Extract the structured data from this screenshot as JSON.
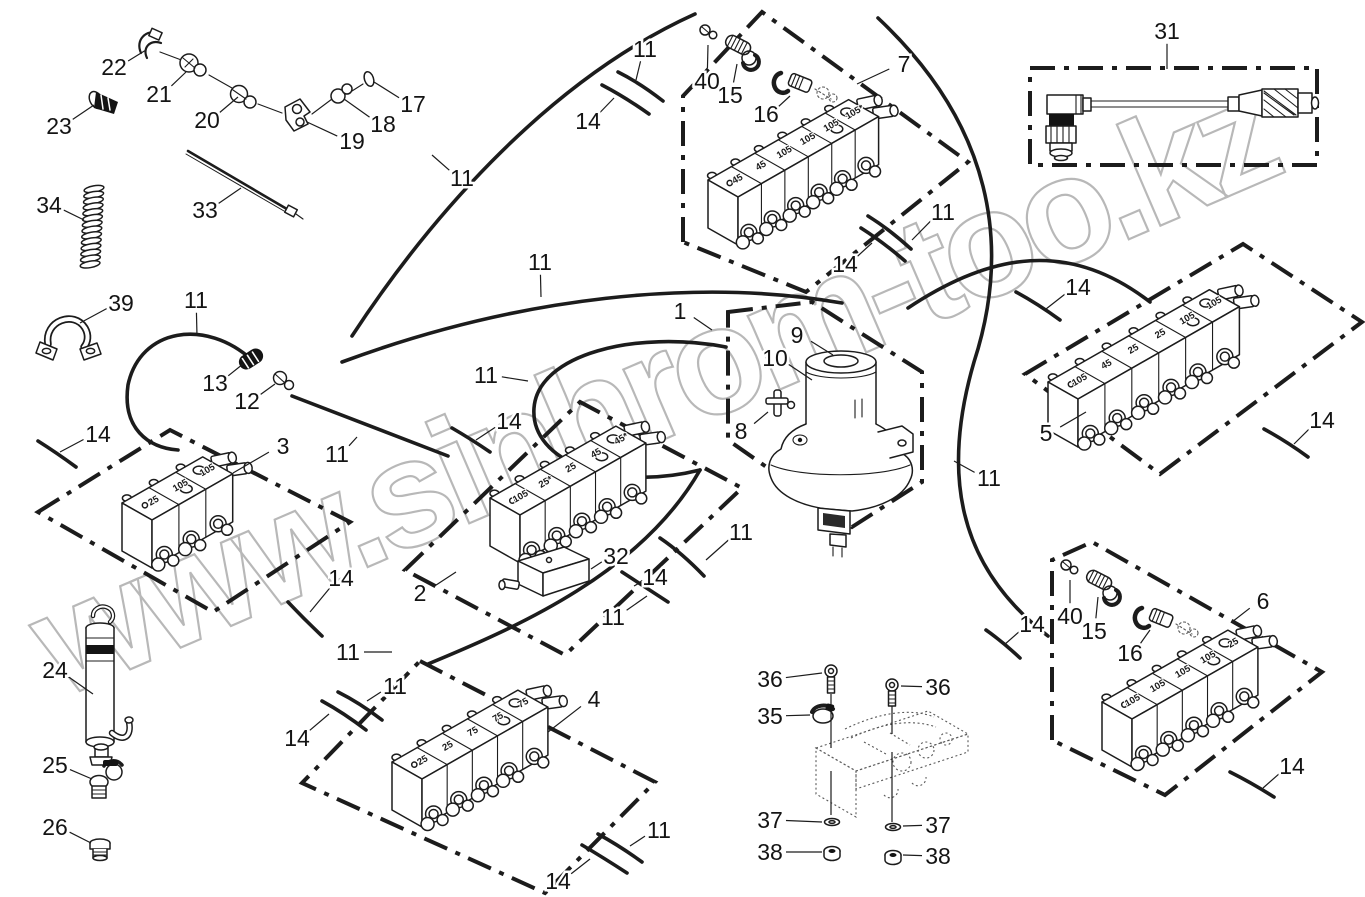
{
  "watermark": {
    "text": "www.sinhrom-too.kz",
    "color": "#acacac"
  },
  "colors": {
    "line": "#1c1c1c",
    "ghost": "#5a5a5a",
    "background": "#ffffff"
  },
  "parts_diagram": {
    "blocks": [
      {
        "ref": "7",
        "x": 708,
        "y": 180,
        "sec": 27,
        "sections": [
          "45",
          "45",
          "105",
          "105",
          "105",
          "105*"
        ]
      },
      {
        "ref": "3",
        "x": 122,
        "y": 503,
        "sec": 31,
        "sections": [
          "25",
          "105",
          "105"
        ]
      },
      {
        "ref": "2",
        "x": 490,
        "y": 498,
        "sec": 29,
        "sections": [
          "105",
          "25*",
          "25",
          "45",
          "45*"
        ]
      },
      {
        "ref": "5",
        "x": 1048,
        "y": 382,
        "sec": 31,
        "sections": [
          "105",
          "45",
          "25",
          "25",
          "105",
          "105"
        ]
      },
      {
        "ref": "4",
        "x": 392,
        "y": 762,
        "sec": 29,
        "sections": [
          "25",
          "25",
          "75",
          "75",
          "75"
        ]
      },
      {
        "ref": "6",
        "x": 1102,
        "y": 702,
        "sec": 29,
        "sections": [
          "105",
          "105",
          "105",
          "105",
          "25"
        ]
      }
    ],
    "callouts": [
      {
        "t": "22",
        "x": 114,
        "y": 67,
        "px": 146,
        "py": 50
      },
      {
        "t": "21",
        "x": 159,
        "y": 94,
        "px": 186,
        "py": 72
      },
      {
        "t": "23",
        "x": 59,
        "y": 126,
        "px": 94,
        "py": 105
      },
      {
        "t": "20",
        "x": 207,
        "y": 120,
        "px": 238,
        "py": 97
      },
      {
        "t": "19",
        "x": 352,
        "y": 141,
        "px": 307,
        "py": 122
      },
      {
        "t": "18",
        "x": 383,
        "y": 124,
        "px": 344,
        "py": 99
      },
      {
        "t": "17",
        "x": 413,
        "y": 104,
        "px": 374,
        "py": 82
      },
      {
        "t": "33",
        "x": 205,
        "y": 210,
        "px": 241,
        "py": 188
      },
      {
        "t": "34",
        "x": 49,
        "y": 205,
        "px": 84,
        "py": 220
      },
      {
        "t": "39",
        "x": 121,
        "y": 303,
        "px": 80,
        "py": 323
      },
      {
        "t": "11",
        "x": 196,
        "y": 300,
        "px": 197,
        "py": 336
      },
      {
        "t": "13",
        "x": 215,
        "y": 383,
        "px": 243,
        "py": 364
      },
      {
        "t": "12",
        "x": 247,
        "y": 401,
        "px": 275,
        "py": 384
      },
      {
        "t": "14",
        "x": 98,
        "y": 434,
        "px": 60,
        "py": 452
      },
      {
        "t": "3",
        "x": 283,
        "y": 446,
        "px": 233,
        "py": 473
      },
      {
        "t": "11",
        "x": 337,
        "y": 454,
        "px": 357,
        "py": 437
      },
      {
        "t": "14",
        "x": 341,
        "y": 578,
        "px": 310,
        "py": 612
      },
      {
        "t": "11",
        "x": 348,
        "y": 652,
        "px": 392,
        "py": 652
      },
      {
        "t": "24",
        "x": 55,
        "y": 670,
        "px": 93,
        "py": 694
      },
      {
        "t": "25",
        "x": 55,
        "y": 765,
        "px": 92,
        "py": 779
      },
      {
        "t": "26",
        "x": 55,
        "y": 827,
        "px": 91,
        "py": 843
      },
      {
        "t": "11",
        "x": 462,
        "y": 178,
        "px": 432,
        "py": 155
      },
      {
        "t": "11",
        "x": 645,
        "y": 49,
        "px": 636,
        "py": 80
      },
      {
        "t": "14",
        "x": 588,
        "y": 121,
        "px": 614,
        "py": 98
      },
      {
        "t": "40",
        "x": 707,
        "y": 81,
        "px": 708,
        "py": 45
      },
      {
        "t": "15",
        "x": 730,
        "y": 95,
        "px": 737,
        "py": 64
      },
      {
        "t": "16",
        "x": 766,
        "y": 114,
        "px": 790,
        "py": 96
      },
      {
        "t": "7",
        "x": 904,
        "y": 64,
        "px": 857,
        "py": 84
      },
      {
        "t": "11",
        "x": 540,
        "y": 262,
        "px": 541,
        "py": 297
      },
      {
        "t": "1",
        "x": 680,
        "y": 311,
        "px": 712,
        "py": 330
      },
      {
        "t": "11",
        "x": 486,
        "y": 375,
        "px": 528,
        "py": 381
      },
      {
        "t": "14",
        "x": 509,
        "y": 421,
        "px": 476,
        "py": 440
      },
      {
        "t": "9",
        "x": 797,
        "y": 335,
        "px": 833,
        "py": 355
      },
      {
        "t": "10",
        "x": 775,
        "y": 358,
        "px": 812,
        "py": 380
      },
      {
        "t": "8",
        "x": 741,
        "y": 431,
        "px": 768,
        "py": 412
      },
      {
        "t": "11",
        "x": 943,
        "y": 212,
        "px": 912,
        "py": 240
      },
      {
        "t": "14",
        "x": 845,
        "y": 264,
        "px": 872,
        "py": 243
      },
      {
        "t": "31",
        "x": 1167,
        "y": 31,
        "px": 1167,
        "py": 69
      },
      {
        "t": "14",
        "x": 1078,
        "y": 287,
        "px": 1046,
        "py": 309
      },
      {
        "t": "5",
        "x": 1046,
        "y": 433,
        "px": 1086,
        "py": 412
      },
      {
        "t": "14",
        "x": 1322,
        "y": 420,
        "px": 1294,
        "py": 444
      },
      {
        "t": "11",
        "x": 989,
        "y": 478,
        "px": 954,
        "py": 461
      },
      {
        "t": "2",
        "x": 420,
        "y": 593,
        "px": 456,
        "py": 572
      },
      {
        "t": "32",
        "x": 616,
        "y": 556,
        "px": 591,
        "py": 569
      },
      {
        "t": "14",
        "x": 655,
        "y": 577,
        "px": 634,
        "py": 586
      },
      {
        "t": "11",
        "x": 741,
        "y": 532,
        "px": 706,
        "py": 560
      },
      {
        "t": "11",
        "x": 613,
        "y": 617,
        "px": 647,
        "py": 596
      },
      {
        "t": "14",
        "x": 1032,
        "y": 624,
        "px": 1004,
        "py": 645
      },
      {
        "t": "40",
        "x": 1070,
        "y": 616,
        "px": 1070,
        "py": 580
      },
      {
        "t": "15",
        "x": 1094,
        "y": 631,
        "px": 1098,
        "py": 597
      },
      {
        "t": "16",
        "x": 1130,
        "y": 653,
        "px": 1150,
        "py": 630
      },
      {
        "t": "6",
        "x": 1263,
        "y": 601,
        "px": 1232,
        "py": 622
      },
      {
        "t": "11",
        "x": 395,
        "y": 686,
        "px": 367,
        "py": 701
      },
      {
        "t": "14",
        "x": 297,
        "y": 738,
        "px": 329,
        "py": 714
      },
      {
        "t": "4",
        "x": 594,
        "y": 699,
        "px": 548,
        "py": 732
      },
      {
        "t": "36",
        "x": 770,
        "y": 679,
        "px": 822,
        "py": 673
      },
      {
        "t": "36",
        "x": 938,
        "y": 687,
        "px": 901,
        "py": 686
      },
      {
        "t": "35",
        "x": 770,
        "y": 716,
        "px": 810,
        "py": 715
      },
      {
        "t": "37",
        "x": 770,
        "y": 820,
        "px": 822,
        "py": 822
      },
      {
        "t": "37",
        "x": 938,
        "y": 825,
        "px": 903,
        "py": 826
      },
      {
        "t": "38",
        "x": 770,
        "y": 852,
        "px": 822,
        "py": 852
      },
      {
        "t": "38",
        "x": 938,
        "y": 856,
        "px": 903,
        "py": 855
      },
      {
        "t": "11",
        "x": 659,
        "y": 830,
        "px": 630,
        "py": 846
      },
      {
        "t": "14",
        "x": 558,
        "y": 881,
        "px": 590,
        "py": 859
      },
      {
        "t": "14",
        "x": 1292,
        "y": 766,
        "px": 1263,
        "py": 788
      }
    ]
  }
}
